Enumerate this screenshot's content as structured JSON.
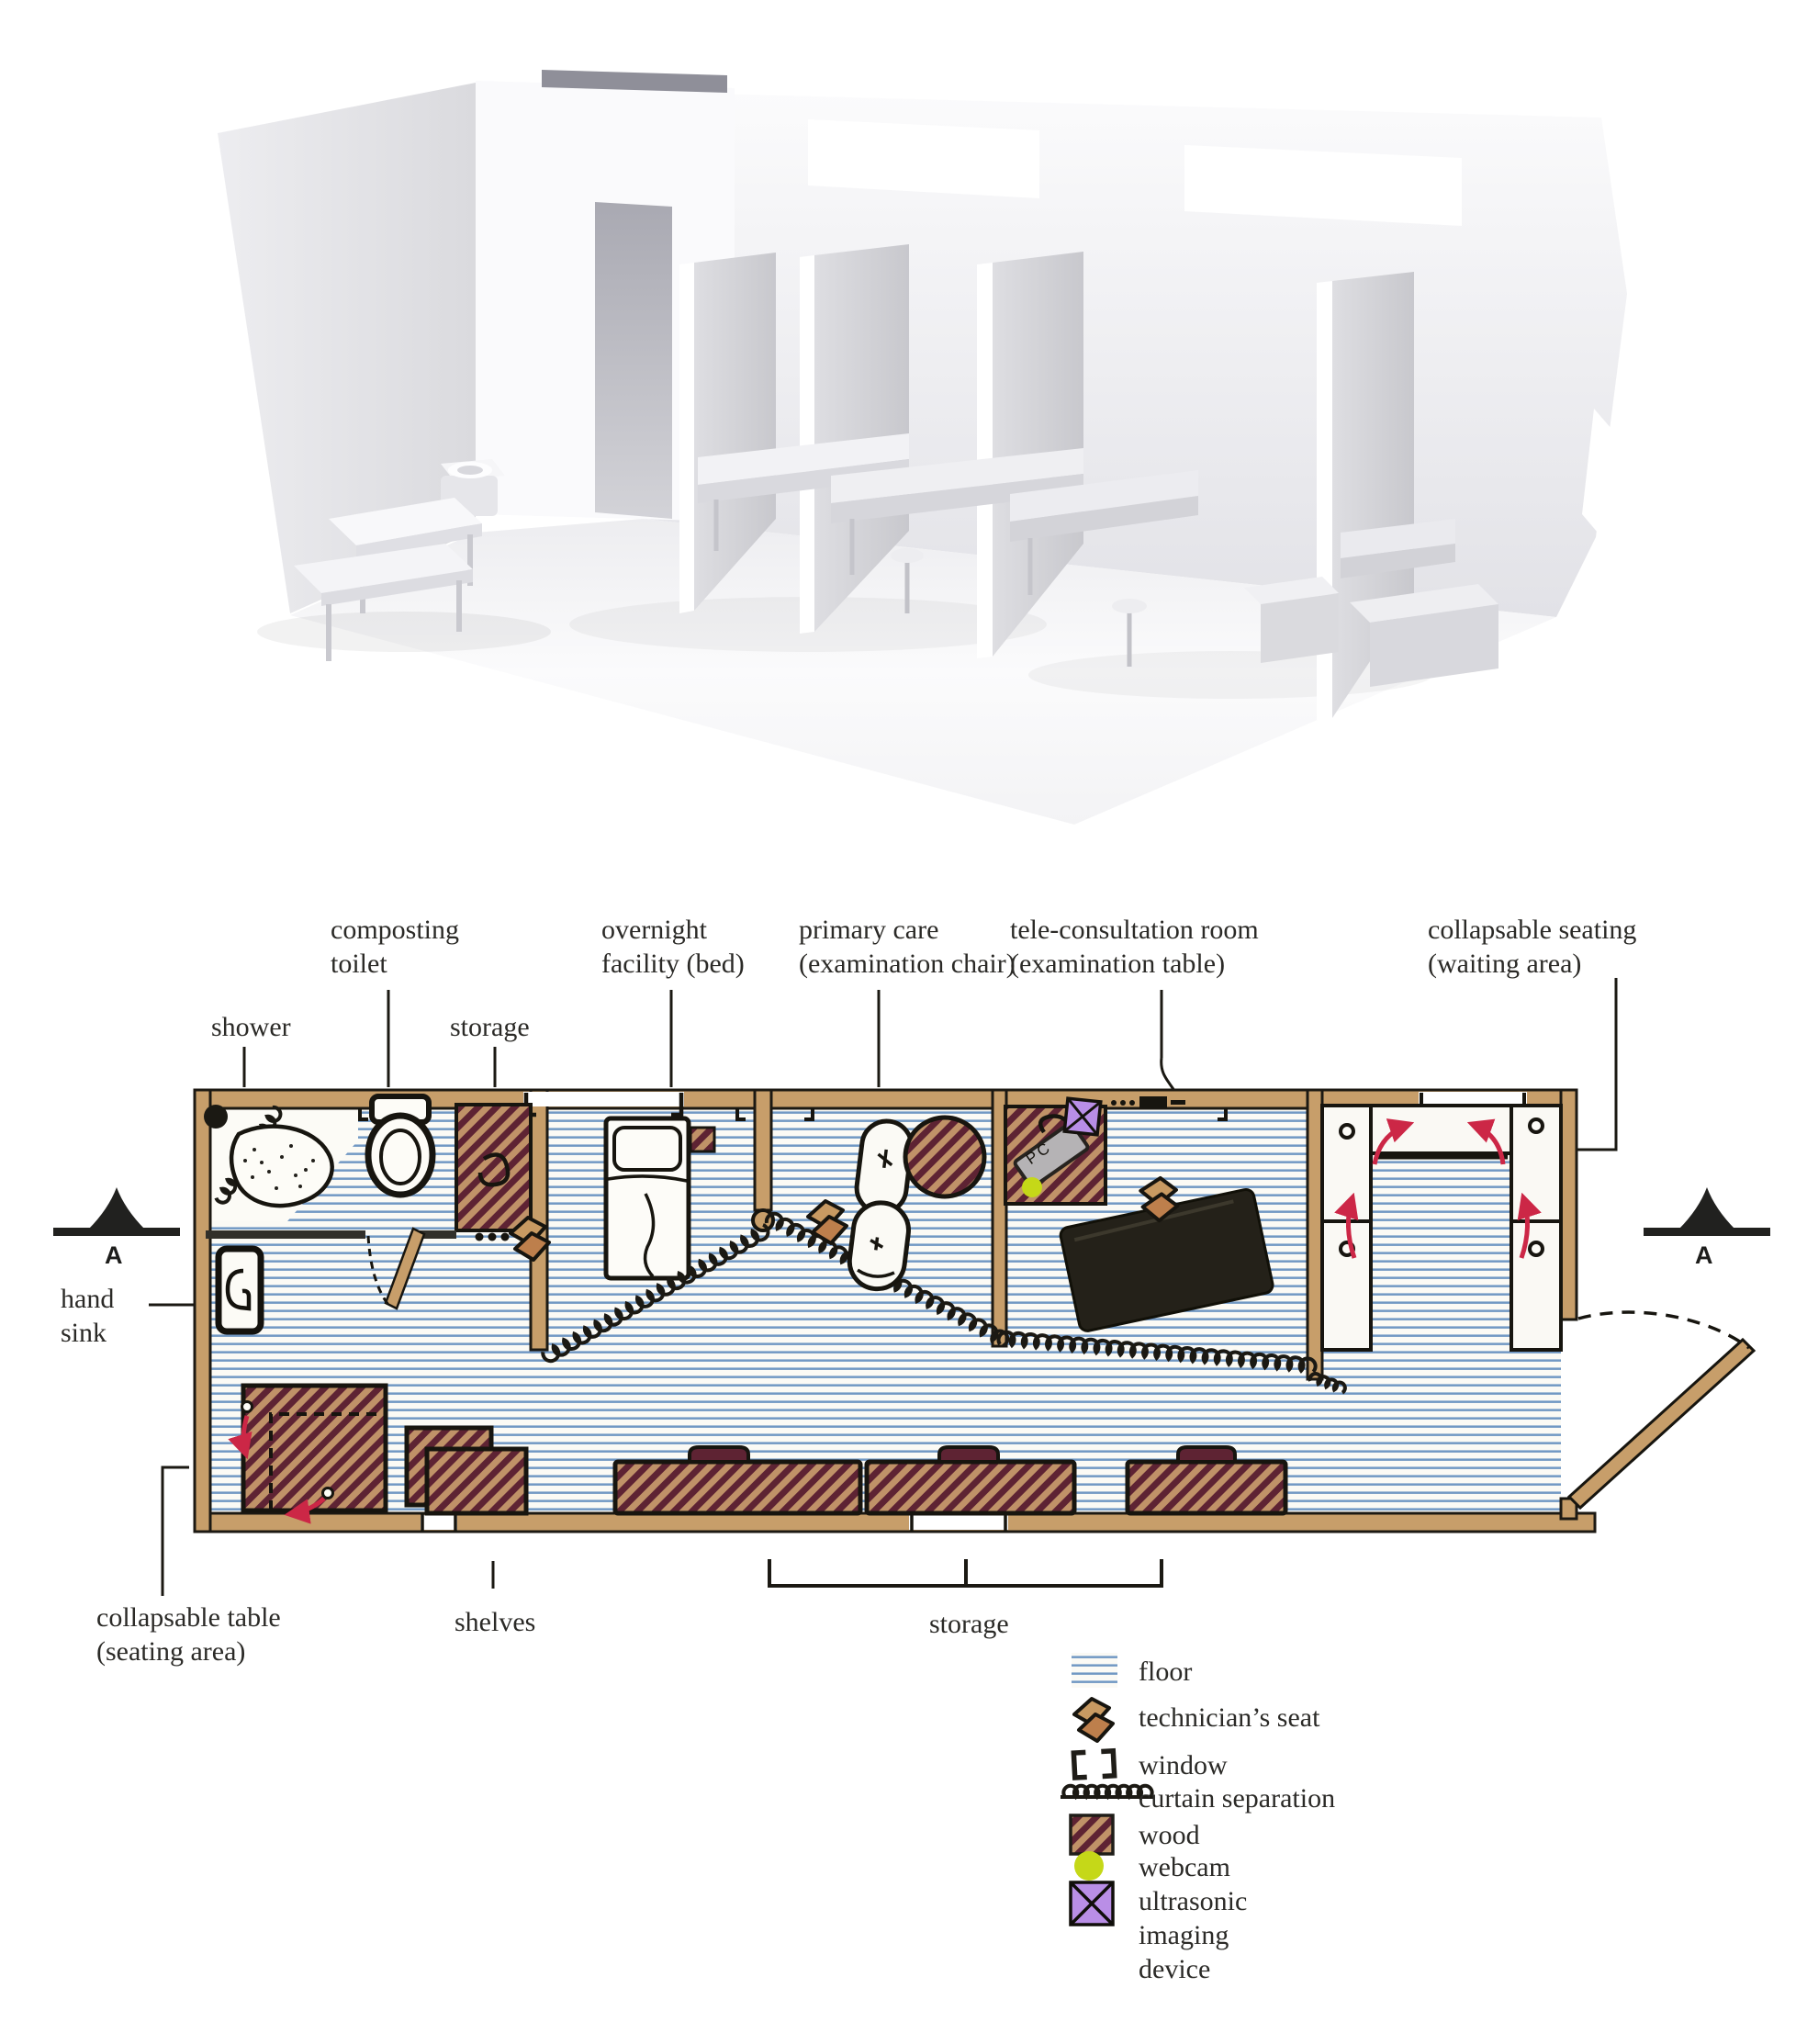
{
  "figure": {
    "type": "architectural-diagram",
    "views": [
      "3d-white-model-cutaway",
      "hand-drawn-floor-plan"
    ]
  },
  "callouts": {
    "shower": [
      "shower"
    ],
    "composting_toilet": [
      "composting",
      "toilet"
    ],
    "storage_top": [
      "storage"
    ],
    "overnight_facility": [
      "overnight",
      "facility (bed)"
    ],
    "primary_care": [
      "primary care",
      "(examination chair)"
    ],
    "tele_consultation": [
      "tele-consultation room",
      "(examination table)"
    ],
    "collapsable_seating": [
      "collapsable seating",
      "(waiting area)"
    ],
    "hand_sink": [
      "hand",
      "sink"
    ],
    "collapsable_table": [
      "collapsable table",
      "(seating area)"
    ],
    "shelves": [
      "shelves"
    ],
    "storage_bottom": [
      "storage"
    ]
  },
  "markers": {
    "section_left": "A",
    "section_right": "A",
    "pc_label": "PC"
  },
  "legend": {
    "items": [
      {
        "icon": "floor-swatch",
        "label": "floor"
      },
      {
        "icon": "technicians-seat",
        "label": "technician’s seat"
      },
      {
        "icon": "window-brackets",
        "label": "window"
      },
      {
        "icon": "curtain-coil",
        "label": "curtain separation"
      },
      {
        "icon": "wood-swatch",
        "label": "wood"
      },
      {
        "icon": "webcam-dot",
        "label": "webcam"
      },
      {
        "icon": "ultrasonic-square",
        "label": "ultrasonic imaging device",
        "lines": [
          "ultrasonic",
          "imaging",
          "device"
        ]
      }
    ]
  },
  "colors": {
    "wall_tan": "#c79e6a",
    "floor_stripe_blue": "#4f7fb8",
    "wood_hatch_maroon": "#5e2333",
    "wood_hatch_tan": "#c09268",
    "webcam_yellow": "#c5d818",
    "ultrasonic_purple": "#b98ee6",
    "arrow_red": "#cc2746",
    "exam_table_black": "#242119"
  }
}
